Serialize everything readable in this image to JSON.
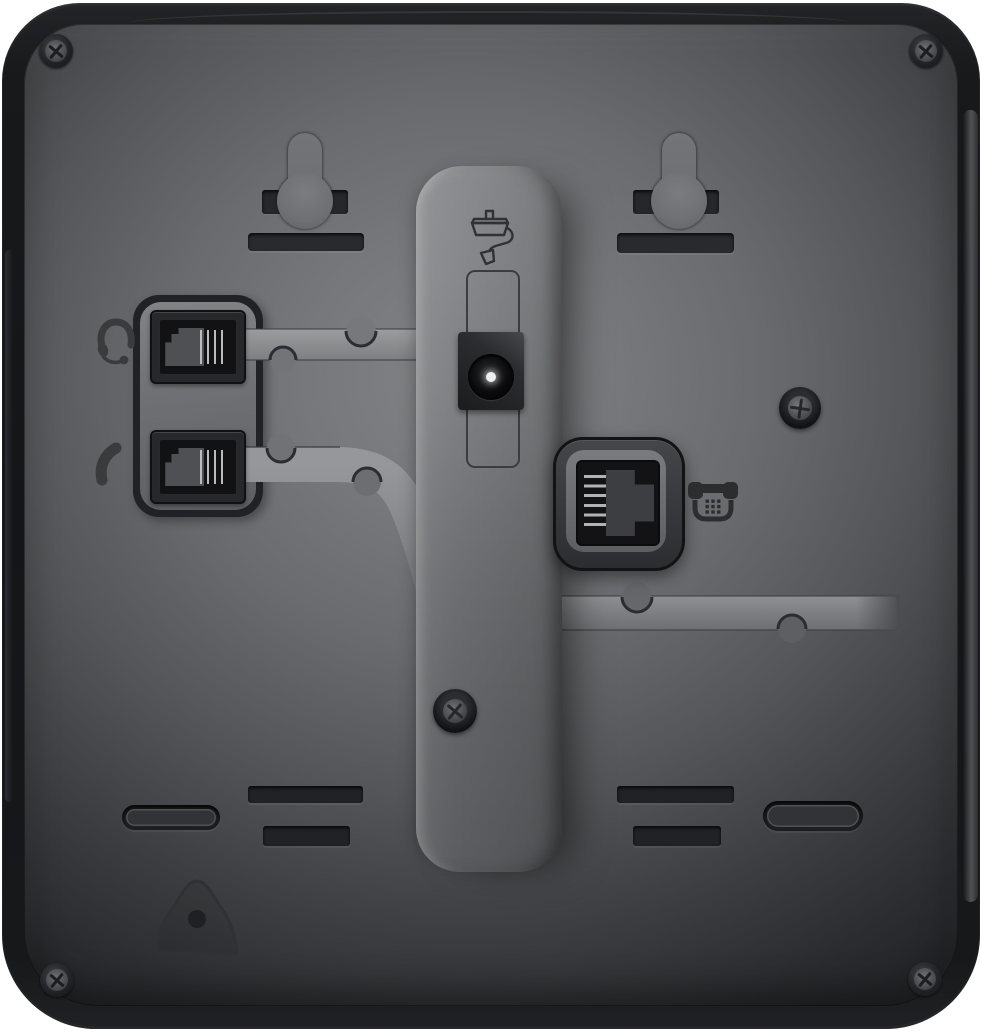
{
  "scene": {
    "type": "product-photo",
    "subject": "Rear panel of a black VoIP desk phone",
    "orientation": "back view, ports and wall-mount features visible",
    "background_color": "#ffffff",
    "body_color": "#1a1b1d",
    "face_color_center": "#7e7f81",
    "face_color_edge": "#27282a",
    "recess_color": "#212225",
    "cable_channel_color": "#939496",
    "contact_pin_color": "#b5b7b8",
    "dc_pin_color": "#eeefef"
  },
  "icons": {
    "power-adapter-icon": "engraved outline of power adapter with cable and plug",
    "headset-icon": "engraved headset with microphone boom",
    "handset-icon": "engraved telephone handset",
    "telephone-icon": "engraved desk telephone with keypad dots"
  },
  "parts": {
    "corner_screw_top_left": {
      "label": "Corner screw (top left)"
    },
    "corner_screw_top_right": {
      "label": "Corner screw (top right)"
    },
    "corner_screw_bottom_left": {
      "label": "Corner screw (bottom left)"
    },
    "corner_screw_bottom_right": {
      "label": "Corner screw (bottom right)"
    },
    "center_screw": {
      "label": "Center screw"
    },
    "side_screw": {
      "label": "Right-side screw"
    },
    "wall_mount_left": {
      "label": "Wall-mount keyhole (left)"
    },
    "wall_mount_right": {
      "label": "Wall-mount keyhole (right)"
    },
    "wall_mount_slot_left": {
      "label": "Wall-mount bracket slot (left)"
    },
    "wall_mount_slot_right": {
      "label": "Wall-mount bracket slot (right)"
    },
    "wall_mount_bar_left": {
      "label": "Wall-mount slot (left lower)"
    },
    "wall_mount_bar_right": {
      "label": "Wall-mount slot (right lower)"
    },
    "stand_channel": {
      "label": "Stand mounting channel"
    },
    "power_icon": {
      "label": "Power adapter icon",
      "icon": "power-adapter-icon"
    },
    "power_outline": {
      "label": "Power port marking outline"
    },
    "power_jack": {
      "label": "DC power jack"
    },
    "jack_plate": {
      "label": "Raised jack plate"
    },
    "headset_icon": {
      "label": "Headset icon",
      "icon": "headset-icon"
    },
    "headset_port": {
      "label": "Headset port (RJ9)"
    },
    "handset_icon": {
      "label": "Handset icon",
      "icon": "handset-icon"
    },
    "handset_port": {
      "label": "Handset port (RJ9)"
    },
    "phone_icon": {
      "label": "Telephone line icon",
      "icon": "telephone-icon"
    },
    "line_port": {
      "label": "Phone line / network port (RJ11)"
    },
    "cable_guide_upper": {
      "label": "Cable routing channel (headset cord)"
    },
    "cable_guide_lower": {
      "label": "Cable routing channel (handset cord)"
    },
    "cable_guide_right": {
      "label": "Cable routing channel (line cord)"
    },
    "vent_slot_left_1": {
      "label": "Slot vent (left upper)"
    },
    "vent_slot_left_2": {
      "label": "Slot vent (left lower)"
    },
    "vent_slot_right_1": {
      "label": "Slot vent (right upper)"
    },
    "vent_slot_right_2": {
      "label": "Slot vent (right lower)"
    },
    "foot_recess_left": {
      "label": "Foot recess (left)"
    },
    "foot_recess_right": {
      "label": "Foot recess (right)"
    },
    "bell_recess": {
      "label": "Bell-shaped recess with hole"
    }
  }
}
